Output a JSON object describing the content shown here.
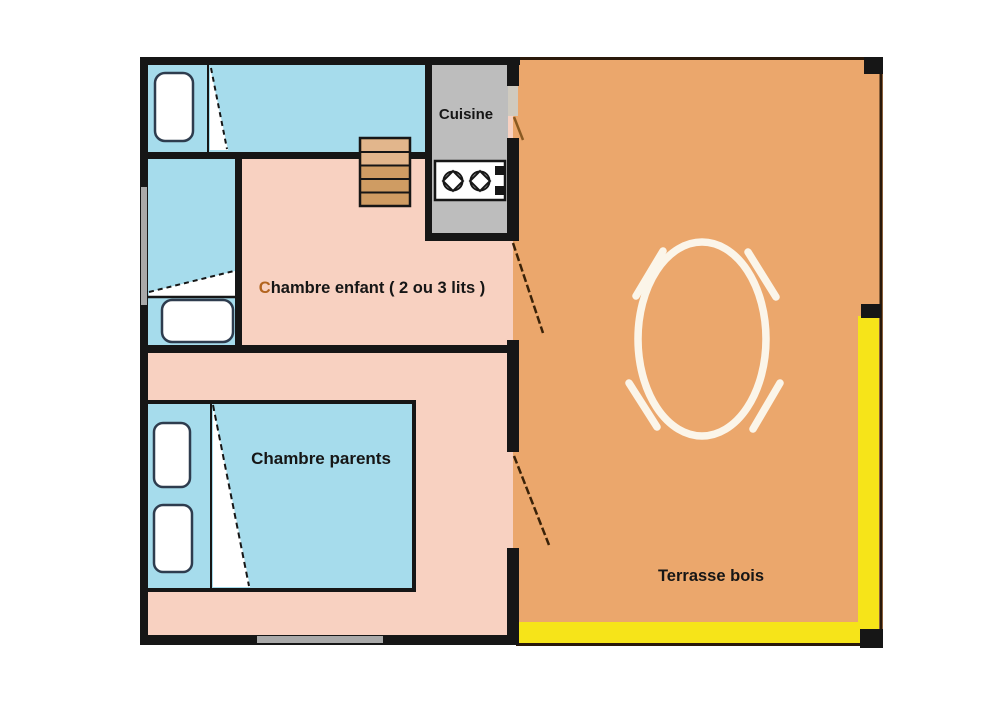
{
  "diagram": {
    "type": "floor-plan",
    "labels": {
      "kitchen": "Cuisine",
      "child_bedroom_initial": "C",
      "child_bedroom_rest": "hambre enfant ( 2 ou 3 lits )",
      "parent_bedroom": "Chambre parents",
      "terrace": "Terrasse bois"
    },
    "colors": {
      "wall": "#161616",
      "floor_pink": "#f8d1c1",
      "bed_blue": "#a6dcec",
      "terrace_orange": "#eba76c",
      "terrace_yellow": "#f6e419",
      "kitchen_gray": "#bdbdbd",
      "stairs_tan": "#cf9c63",
      "stairs_tan_light": "#e2b68c",
      "window_gray": "#a9a9a9",
      "kitchen_gap_gray": "#cfcabf",
      "furniture_white": "#ffffff",
      "table_white": "#fbf5e9",
      "outline_dark": "#2a190a",
      "pillow_border": "#2e3c4e",
      "door_dash": "#3a2208",
      "kitchen_door_dash": "#8a5a22",
      "label_color": "#161616",
      "child_label_initial_color": "#b2641f"
    }
  }
}
